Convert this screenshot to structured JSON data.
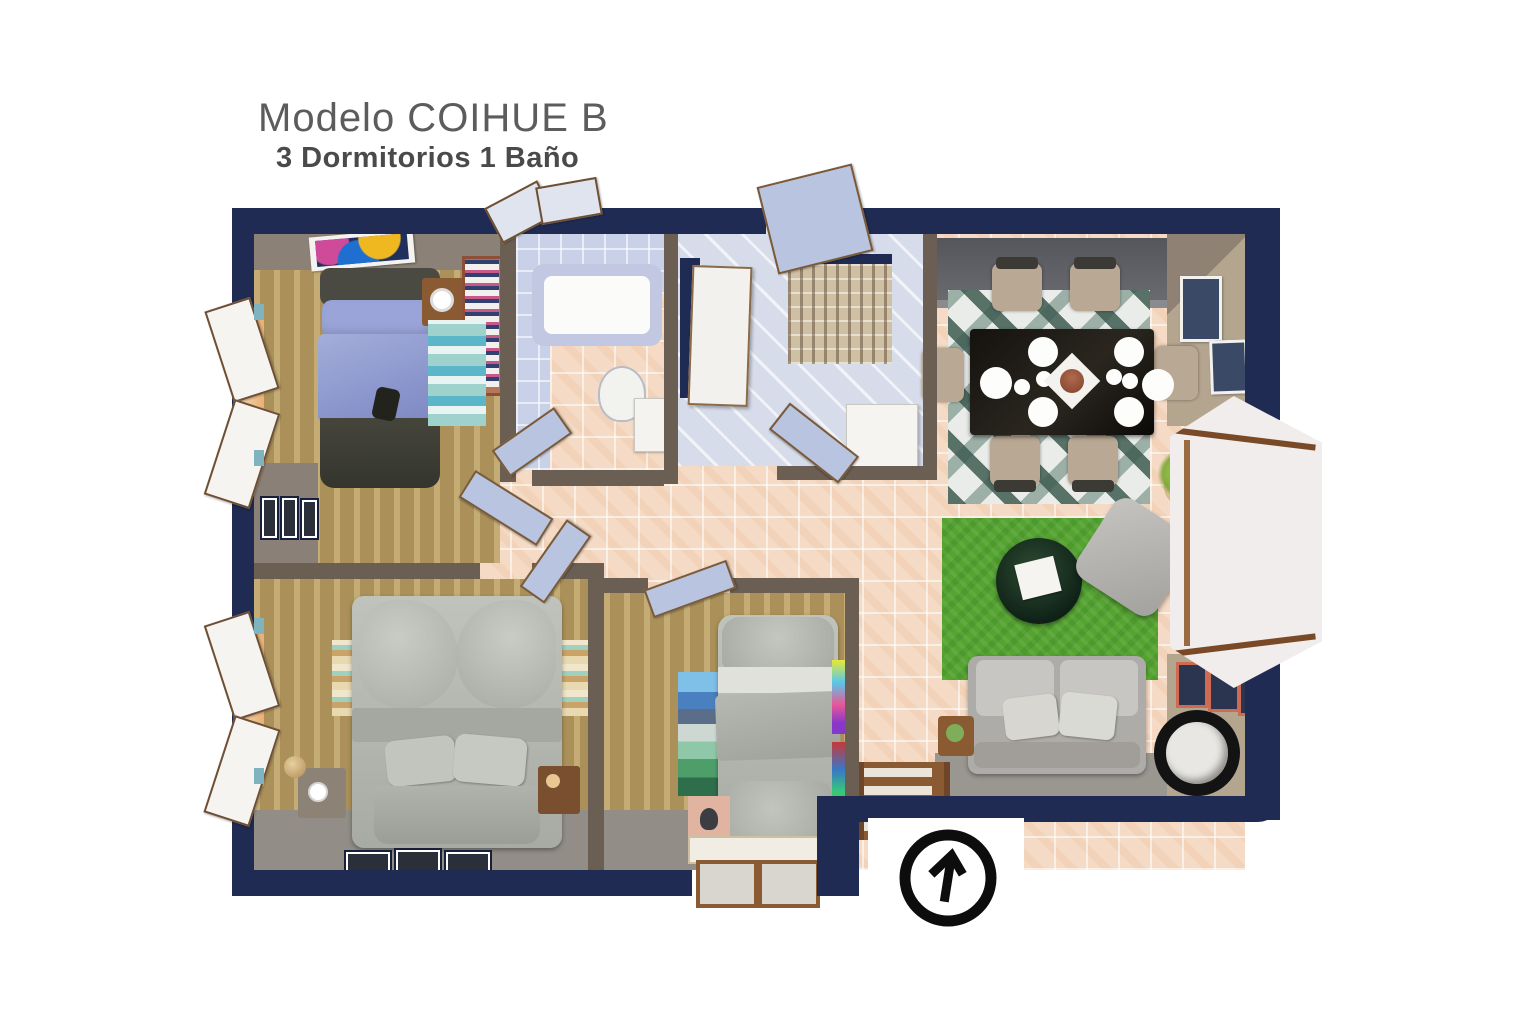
{
  "header": {
    "title": "Modelo COIHUE B",
    "subtitle": "3 Dormitorios  1 Baño"
  },
  "compass": {
    "icon": "north-arrow-icon",
    "direction": "up"
  },
  "colors": {
    "wall_navy": "#1f2b52",
    "interior_wall": "#6b5e53",
    "floor_tile": "#f5dbc5",
    "floor_carpet": "#ab9159",
    "bathroom_tile": "#c9d1e8",
    "rug_green": "#55a431",
    "furniture_gray": "#b3b5b0",
    "bed_blue": "#8b96cd",
    "door_panel": "#b9c5e0",
    "door_frame": "#7a5a38",
    "wood": "#8a5a33",
    "accent_teal": "#7fb3c0",
    "title_color": "#5c5c5c",
    "subtitle_color": "#4a4a4a"
  }
}
